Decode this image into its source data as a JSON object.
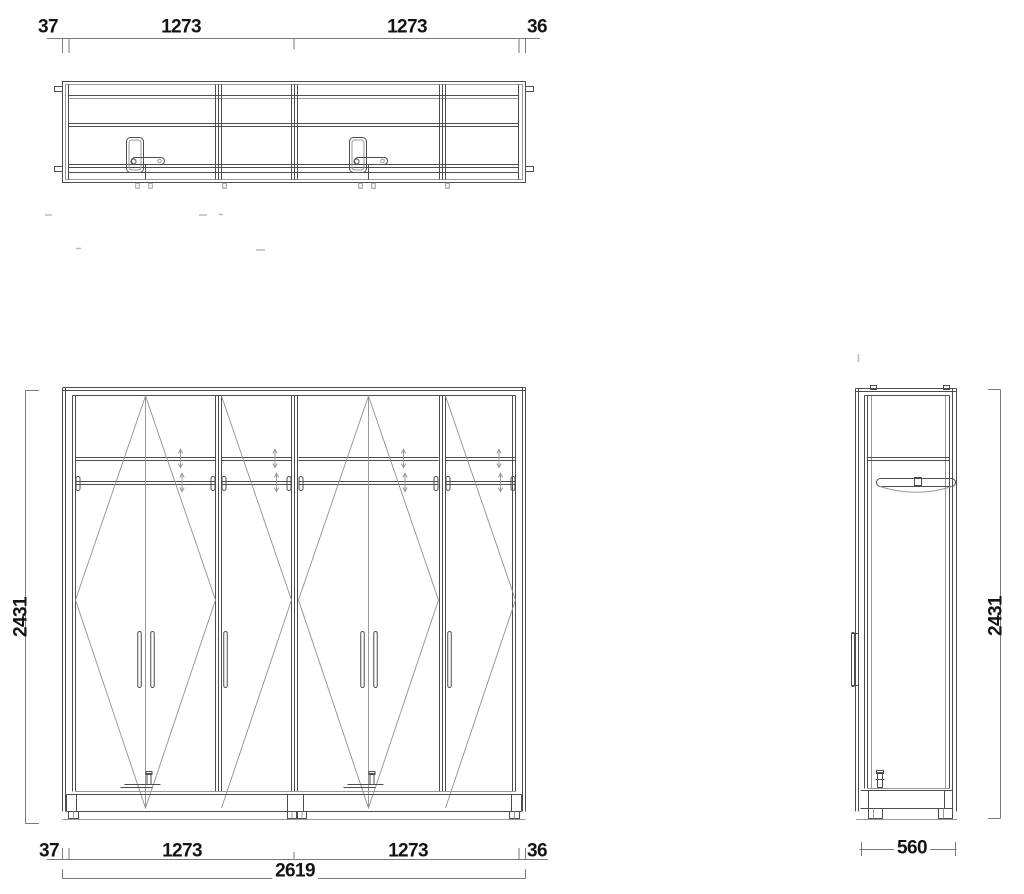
{
  "drawing": {
    "type": "wardrobe-technical-drawing",
    "background": "#ffffff",
    "line_color": "#4d4d4d",
    "light_line_color": "#8f8f8f",
    "dimension_line_color": "#7a7a7a",
    "text_color": "#141414"
  },
  "views": {
    "plan": "top-view",
    "front": "front-elevation",
    "side": "side-elevation"
  },
  "dimensions": {
    "plan_top": {
      "left_wall": "37",
      "door_left": "1273",
      "door_right": "1273",
      "right_wall": "36"
    },
    "front_bottom": {
      "left_wall": "37",
      "door_left": "1273",
      "door_right": "1273",
      "right_wall": "36",
      "overall_width": "2619"
    },
    "front_height": "2431",
    "side_height": "2431",
    "side_depth": "560"
  }
}
